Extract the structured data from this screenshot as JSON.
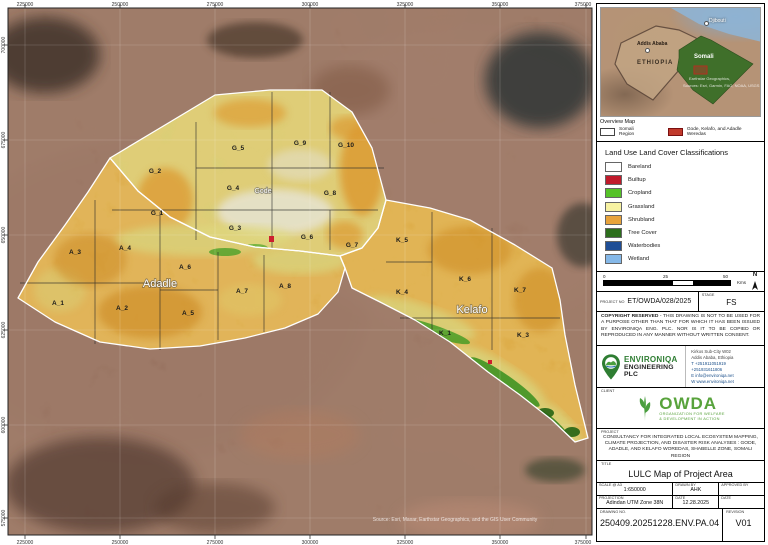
{
  "map": {
    "coords": {
      "top": [
        "225000",
        "250000",
        "275000",
        "300000",
        "325000",
        "350000",
        "375000"
      ],
      "bottom": [
        "225000",
        "250000",
        "275000",
        "300000",
        "325000",
        "350000",
        "375000"
      ],
      "left": [
        "700000",
        "675000",
        "650000",
        "625000",
        "600000",
        "575000"
      ]
    },
    "wereda_names": {
      "gode": "Gode",
      "adadle": "Adadle",
      "kelafo": "Kelafo"
    },
    "cells": {
      "gode": [
        "G_2",
        "G_5",
        "G_9",
        "G_10",
        "G_4",
        "G_8",
        "G_1",
        "G_3",
        "G_6",
        "G_7"
      ],
      "adadle": [
        "A_3",
        "A_4",
        "A_6",
        "A_7",
        "A_8",
        "A_1",
        "A_2",
        "A_5"
      ],
      "kelafo": [
        "K_5",
        "K_6",
        "K_7",
        "K_4",
        "K_1",
        "K_3"
      ]
    },
    "attribution": "Source: Esri, Maxar, Earthstar Geographics, and the GIS User Community"
  },
  "overview": {
    "title": "Overview Map",
    "labels": {
      "djibouti": "Djibouti",
      "addis_ababa": "Addis Ababa",
      "ethiopia": "ETHIOPIA",
      "somali": "Somali"
    },
    "attribution_line1": "Earthstar Geographics,",
    "attribution_line2": "Sources: Esri, Garmin, FAO, NOAA, USGS",
    "legend": [
      {
        "label": "Somali Region",
        "color": "#ffffff"
      },
      {
        "label": "Gode, Kelafo, and Adadle Weredas",
        "color": "#c0392b"
      }
    ]
  },
  "lulc_legend": {
    "title": "Land Use Land Cover Classifications",
    "items": [
      {
        "label": "Bareland",
        "color": "#ffffff"
      },
      {
        "label": "Builtup",
        "color": "#c01a2b"
      },
      {
        "label": "Cropland",
        "color": "#55c228"
      },
      {
        "label": "Grassland",
        "color": "#f7f2a2"
      },
      {
        "label": "Shrubland",
        "color": "#e8a33c"
      },
      {
        "label": "Tree Cover",
        "color": "#2d6e1d"
      },
      {
        "label": "Waterbodies",
        "color": "#1f4e96"
      },
      {
        "label": "Wetland",
        "color": "#85b8e8"
      }
    ]
  },
  "scalebar": {
    "t0": "0",
    "t25": "25",
    "t50": "50",
    "unit": "Kms",
    "north": "N"
  },
  "titleblock": {
    "project_no_label": "PROJECT No",
    "project_no": "ET/OWDA/028/2025",
    "stage_label": "STAGE",
    "stage": "FS",
    "copyright_bold": "COPYRIGHT RESERVED",
    "copyright_rest": " - THIS DRAWING IS NOT TO BE USED FOR A PURPOSE OTHER THAN THAT FOR WHICH IT HAS BEEN ISSUED BY ENVIRONIQA ENG. PLC. NOR IS IT TO BE COPIED OR REPRODUCED IN ANY MANNER WITHOUT WRITTEN CONSENT.",
    "company": {
      "name1": "ENVIRONIQA",
      "name2": "ENGINEERING PLC",
      "contact": [
        "Kirkos Sub-City W02",
        "Addis Ababa, Ethiopia",
        "T +251911051919",
        "   +251931611806",
        "E info@environiqa.net",
        "W www.environiqa.net"
      ]
    },
    "client_label": "CLIENT",
    "client": {
      "name": "OWDA",
      "subtitle1": "ORGANIZATION FOR WELFARE",
      "subtitle2": "& DEVELOPMENT IN ACTION"
    },
    "project_label": "PROJECT",
    "project": "CONSULTANCY FOR INTEGRATED LOCAL ECOSYSTEM MAPPING, CLIMATE PROJECTION, AND DISASTER RISK ANALYSES : GODE, ADADLE, AND KELAFO WOREDAS, SHABELLE ZONE, SOMALI REGION",
    "title_label": "TITLE",
    "title": "LULC Map of Project Area",
    "scale_label": "SCALE @ A3",
    "scale": "1:650000",
    "drawn_label": "DRAWN BY",
    "drawn": "AHK",
    "approved_label": "APPROVED BY",
    "approved": "",
    "projection_label": "Projection",
    "projection": "Adindan UTM Zone 38N",
    "date_label": "DATE",
    "date": "12.28.2025",
    "date2_label": "DATE",
    "date2": "",
    "drawing_label": "DRAWING No.",
    "drawing": "250409.20251228.ENV.PA.04",
    "revision_label": "REVISION",
    "revision": "V01"
  }
}
